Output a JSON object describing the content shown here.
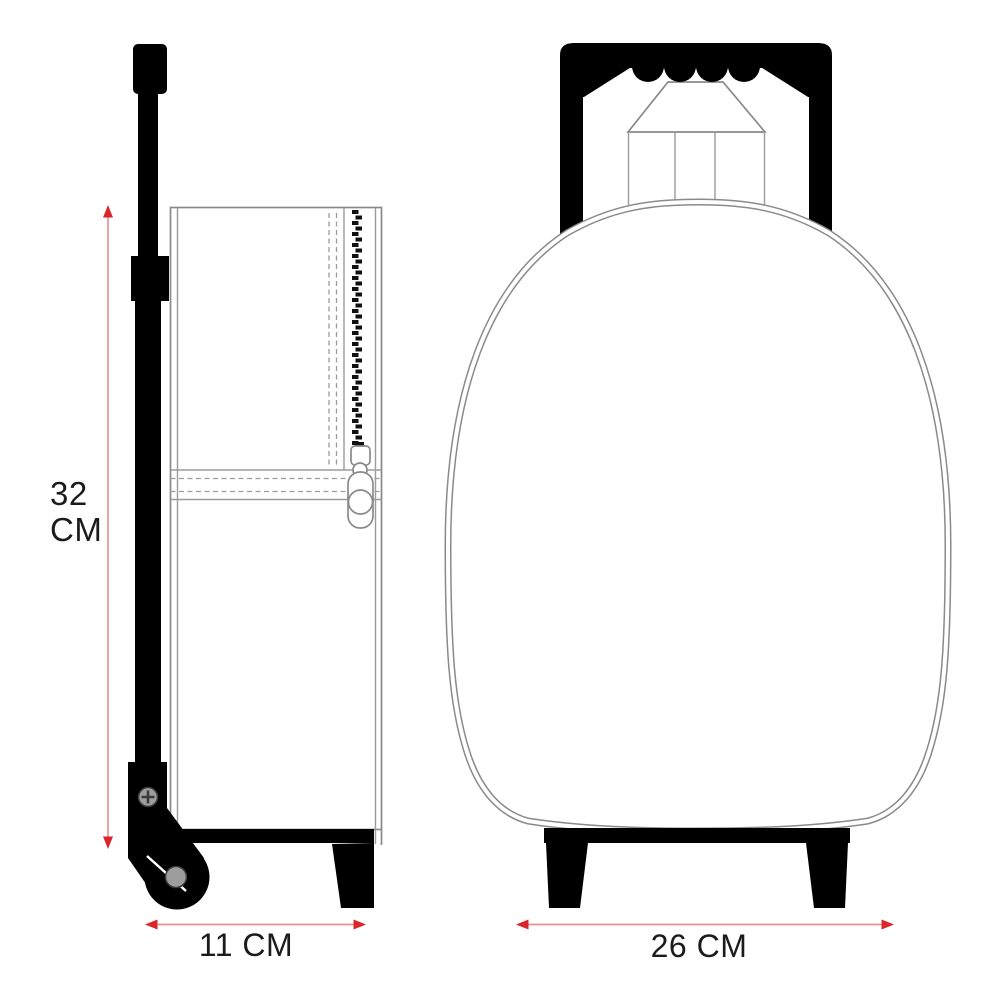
{
  "title": "Trolley backpack dimension diagram",
  "dimensions": {
    "height": {
      "value": "32",
      "unit": "CM",
      "label": "32 CM"
    },
    "depth": {
      "label": "11 CM"
    },
    "width": {
      "label": "26 CM"
    }
  },
  "views": {
    "side_view": {
      "parts": [
        "handle-grip",
        "telescopic-pole",
        "pole-collar",
        "backpack-body-side",
        "front-pocket-zipper",
        "zipper-pull",
        "wheel-bracket",
        "bracket-screw",
        "wheel",
        "wheel-hub",
        "rear-foot"
      ]
    },
    "front_view": {
      "parts": [
        "trolley-handle-bar",
        "handle-finger-grooves",
        "trolley-side-poles",
        "trolley-center-mount",
        "backpack-body-front",
        "base-bar",
        "left-foot",
        "right-foot"
      ]
    }
  },
  "colors": {
    "ink": "#000000",
    "outline": "#8a8a8a",
    "outline_light": "#9b9b9b",
    "dim_line": "#e59393",
    "dim_arrow": "#d8262c",
    "metal": "#9d9d9d",
    "metal_edge": "#3a3a3a",
    "text": "#1b1b1b",
    "background": "#ffffff"
  }
}
